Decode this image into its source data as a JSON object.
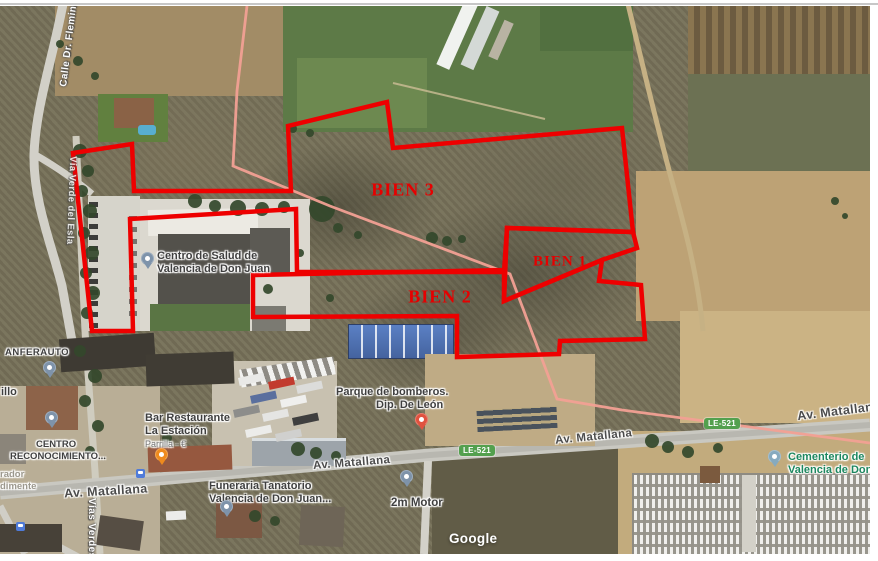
{
  "parcels": {
    "p1": "BIEN 1",
    "p2": "BIEN 2",
    "p3": "BIEN 3"
  },
  "streets": {
    "calle_fleming": "Calle Dr. Fleming",
    "via_verde_upper": "Vía Verde del Esla",
    "via_verde_lower": "Vías Verdes",
    "av_matallana": "Av. Matallana"
  },
  "badges": {
    "le521": "LE-521"
  },
  "pois": {
    "centro_salud": {
      "line1": "Centro de Salud de",
      "line2": "Valencia de Don Juan"
    },
    "anferauto": "ANFERAUTO",
    "illo": "illo",
    "reconocimiento": {
      "line1": "CENTRO",
      "line2": "RECONOCIMIENTO..."
    },
    "rador": "rador",
    "dimente": "dimente",
    "bar": {
      "line1": "Bar Restaurante",
      "line2": "La Estación",
      "line3": "Parrilla · €"
    },
    "bomberos": {
      "line1": "Parque de bomberos.",
      "line2": "Dip. De León"
    },
    "funeraria": {
      "line1": "Funeraria Tanatorio",
      "line2": "Valencia de Don Juan..."
    },
    "motor": "2m Motor",
    "cementerio": {
      "line1": "Cementerio de",
      "line2": "Valencia de Don ."
    }
  },
  "watermark": "Google",
  "colors": {
    "parcel_outline": "#ee0000",
    "parcel_label": "#e60000",
    "route_badge": "#53a04e",
    "cemetery_label": "#1c875f",
    "greenway_line": "#f2a093",
    "poi_pin": "#7e93aa",
    "restaurant_pin": "#ef8a1d",
    "fire_pin": "#e0523f",
    "cemetery_pin": "#86aabf",
    "transit_icon": "#4f7bd9"
  }
}
